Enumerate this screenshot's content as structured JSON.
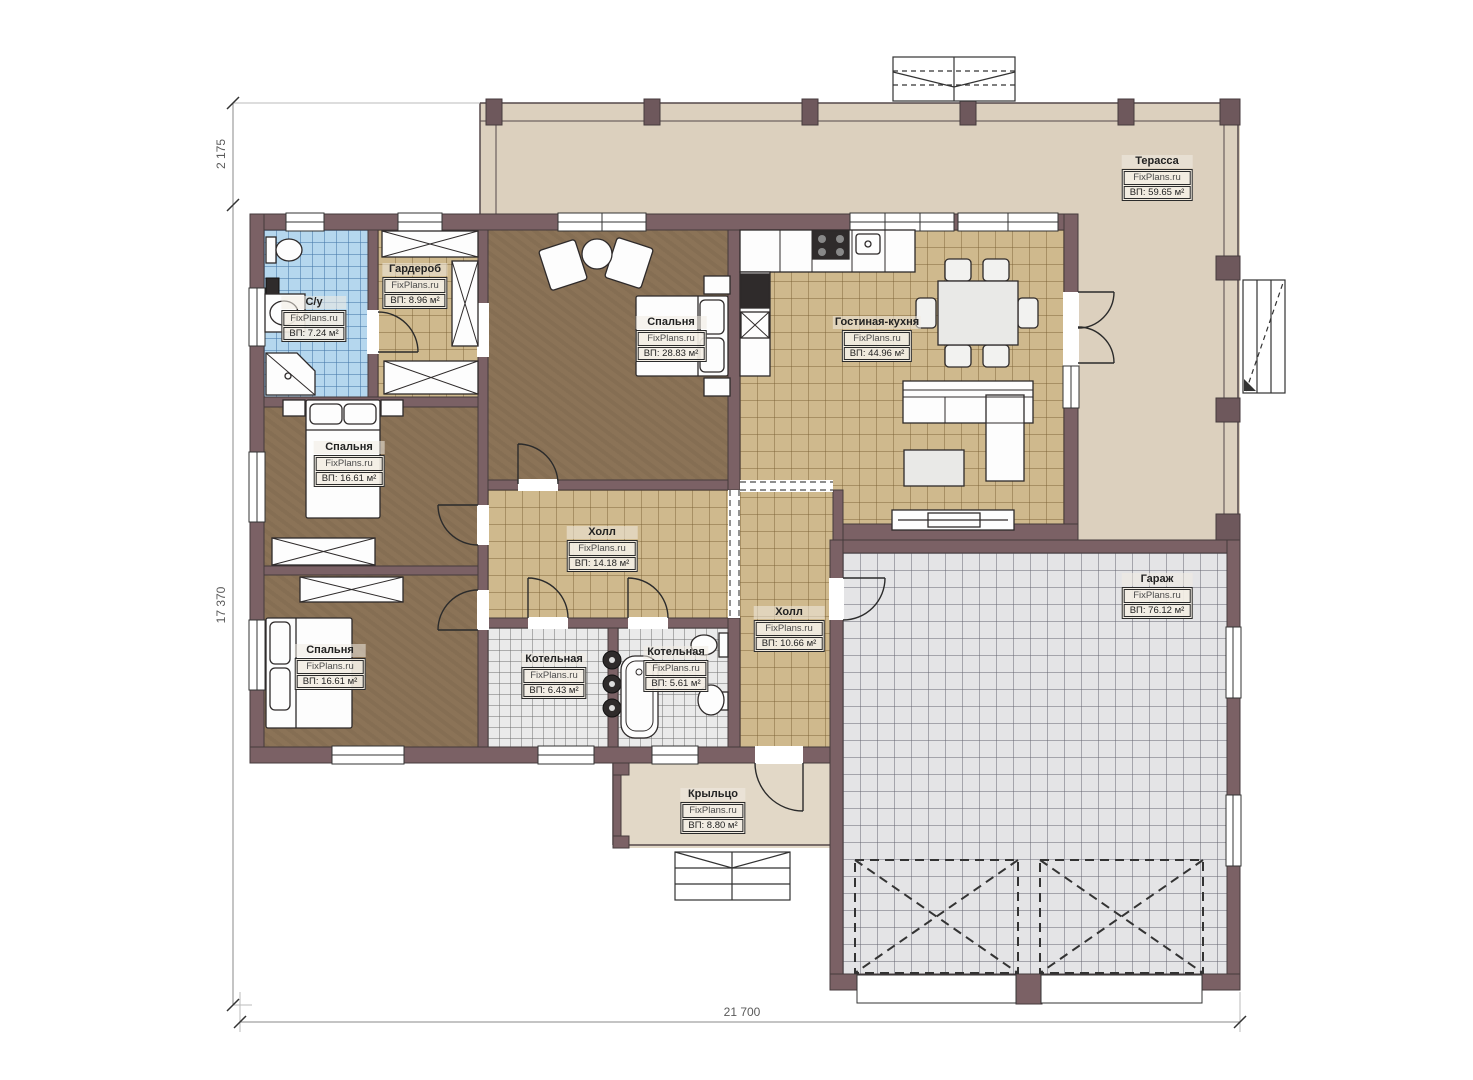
{
  "plan": {
    "brand": "FixPlans.ru",
    "rooms": [
      {
        "id": "terrace",
        "name": "Терасса",
        "brand": "FixPlans.ru",
        "area": "ВП: 59.65 м²"
      },
      {
        "id": "su",
        "name": "С/у",
        "brand": "FixPlans.ru",
        "area": "ВП: 7.24 м²"
      },
      {
        "id": "wardrobe",
        "name": "Гардероб",
        "brand": "FixPlans.ru",
        "area": "ВП: 8.96 м²"
      },
      {
        "id": "bedroom-master",
        "name": "Спальня",
        "brand": "FixPlans.ru",
        "area": "ВП: 28.83 м²"
      },
      {
        "id": "living-kitchen",
        "name": "Гостиная-кухня",
        "brand": "FixPlans.ru",
        "area": "ВП: 44.96 м²"
      },
      {
        "id": "bedroom-2",
        "name": "Спальня",
        "brand": "FixPlans.ru",
        "area": "ВП: 16.61 м²"
      },
      {
        "id": "hall-1",
        "name": "Холл",
        "brand": "FixPlans.ru",
        "area": "ВП: 14.18 м²"
      },
      {
        "id": "hall-2",
        "name": "Холл",
        "brand": "FixPlans.ru",
        "area": "ВП: 10.66 м²"
      },
      {
        "id": "bedroom-3",
        "name": "Спальня",
        "brand": "FixPlans.ru",
        "area": "ВП: 16.61 м²"
      },
      {
        "id": "boiler-1",
        "name": "Котельная",
        "brand": "FixPlans.ru",
        "area": "ВП: 6.43 м²"
      },
      {
        "id": "boiler-2",
        "name": "Котельная",
        "brand": "FixPlans.ru",
        "area": "ВП: 5.61 м²"
      },
      {
        "id": "garage",
        "name": "Гараж",
        "brand": "FixPlans.ru",
        "area": "ВП: 76.12 м²"
      },
      {
        "id": "porch",
        "name": "Крыльцо",
        "brand": "FixPlans.ru",
        "area": "ВП: 8.80 м²"
      }
    ],
    "dimensions": {
      "top_offset": "2 175",
      "left_total": "17 370",
      "bottom_total": "21 700"
    },
    "colors": {
      "wall": "#7b6165",
      "floor_wood": "#8b7357",
      "floor_tile_tan": "#cfb98d",
      "floor_tile_gray": "#eaeaea",
      "floor_tile_blue": "#b5d7ee",
      "floor_garage": "#e4e4e6",
      "terrace": "#dcd0be",
      "porch": "#e2d8c7"
    }
  }
}
